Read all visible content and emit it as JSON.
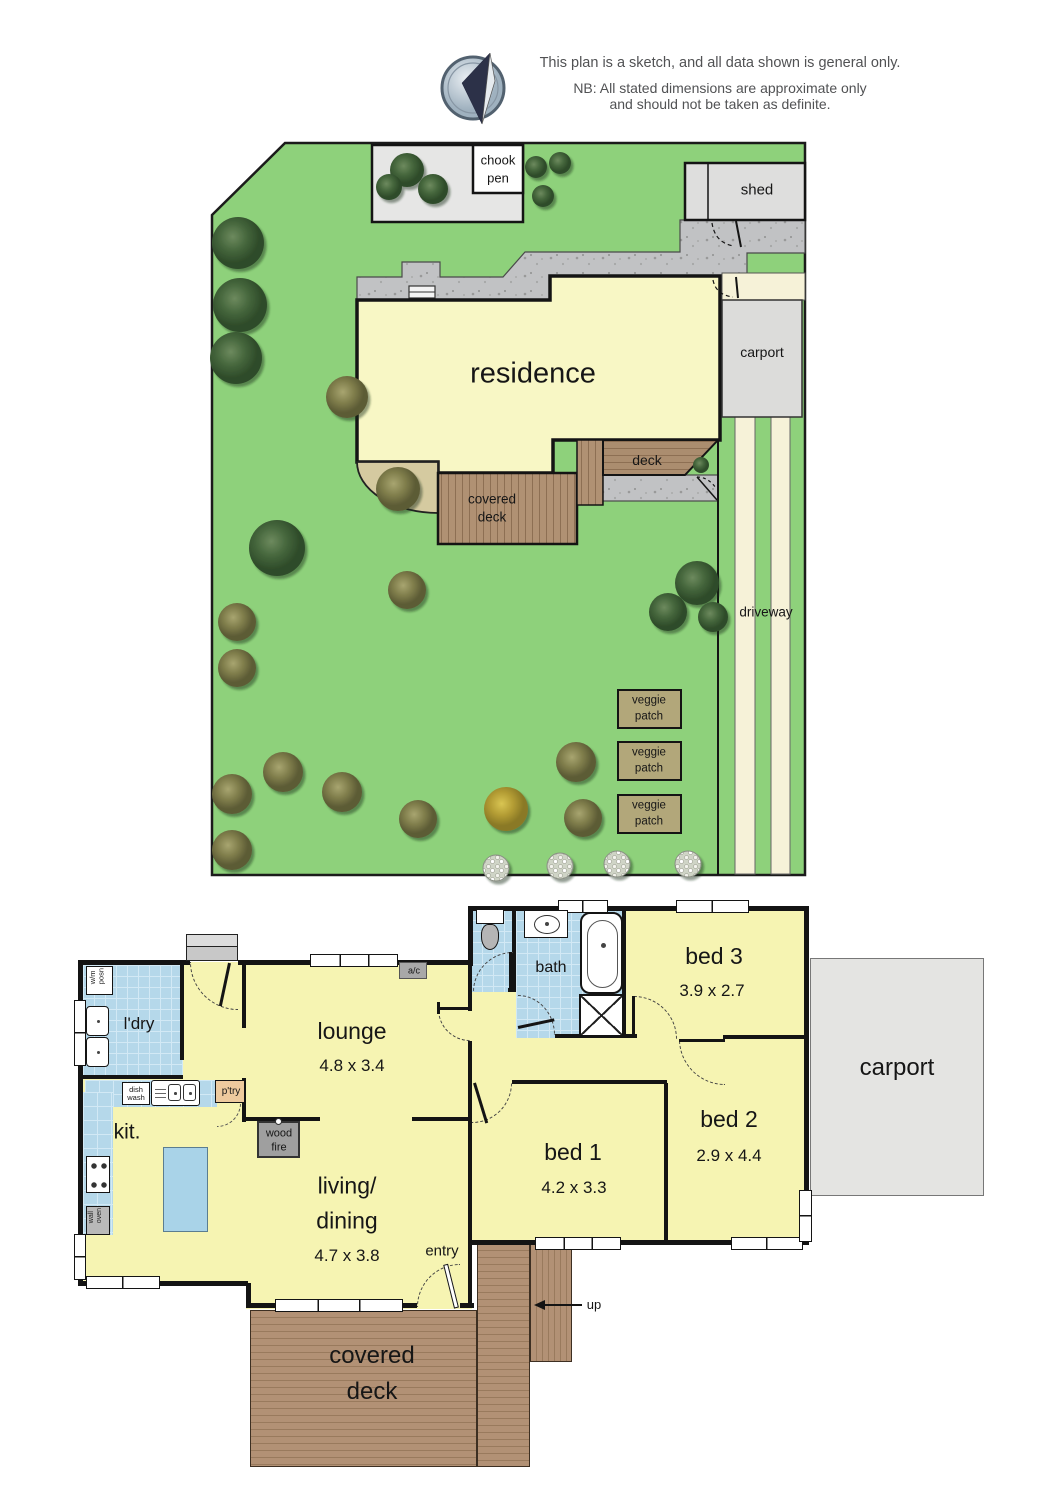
{
  "header": {
    "disclaimer_line1": "This plan is a sketch, and all data shown is general only.",
    "disclaimer_line2": "NB: All stated dimensions are approximate only",
    "disclaimer_line3": "and should not be taken as definite."
  },
  "site_plan": {
    "residence": "residence",
    "shed": "shed",
    "carport": "carport",
    "deck": "deck",
    "covered_deck": "covered\ndeck",
    "chook_pen": "chook\npen",
    "driveway": "driveway",
    "veggie_patches": [
      "veggie\npatch",
      "veggie\npatch",
      "veggie\npatch"
    ]
  },
  "floor_plan": {
    "laundry": "l'dry",
    "lounge": "lounge",
    "lounge_dim": "4.8 x 3.4",
    "kitchen": "kit.",
    "living_dining": "living/\ndining",
    "living_dining_dim": "4.7 x 3.8",
    "entry": "entry",
    "bed1": "bed 1",
    "bed1_dim": "4.2 x 3.3",
    "bed2": "bed 2",
    "bed2_dim": "2.9 x 4.4",
    "bed3": "bed 3",
    "bed3_dim": "3.9 x 2.7",
    "bath": "bath",
    "carport": "carport",
    "covered_deck": "covered\ndeck",
    "up": "up",
    "wood_fire": "wood\nfire",
    "ac": "a/c",
    "pantry": "p'try",
    "dish_wash": "dish\nwash",
    "wm_position": "w/m\nposn",
    "wall_oven": "wall\noven"
  },
  "colors": {
    "lawn": "#8ed17b",
    "room_yellow": "#f6f4b2",
    "residence_yellow": "#f8f7c5",
    "tile_blue": "#b5d8ea",
    "deck_brown": "#b29175",
    "path_gray": "#c1c2c4",
    "carport_gray": "#e4e4e2",
    "driveway_cream": "#f6f2d8",
    "veggie_tan": "#b2a77a",
    "wall_black": "#141414"
  }
}
